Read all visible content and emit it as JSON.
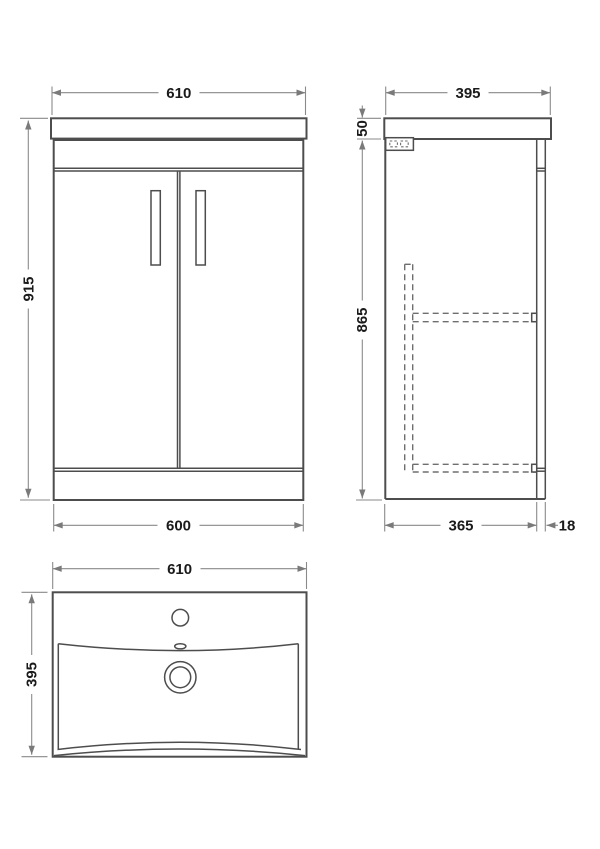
{
  "drawing": {
    "colors": {
      "structure_line": "#4d4d4d",
      "dimension_line": "#8a8a8a",
      "hidden_line": "#6e6e6e",
      "text": "#1a1a1a",
      "background": "#ffffff"
    }
  },
  "front_view": {
    "dims": {
      "top_width": "610",
      "height": "915",
      "bottom_width": "600"
    }
  },
  "side_view": {
    "dims": {
      "top_depth": "395",
      "worktop_height": "50",
      "cabinet_height": "865",
      "bottom_depth": "365",
      "door_thickness": "18"
    }
  },
  "basin_view": {
    "dims": {
      "width": "610",
      "depth": "395"
    }
  }
}
